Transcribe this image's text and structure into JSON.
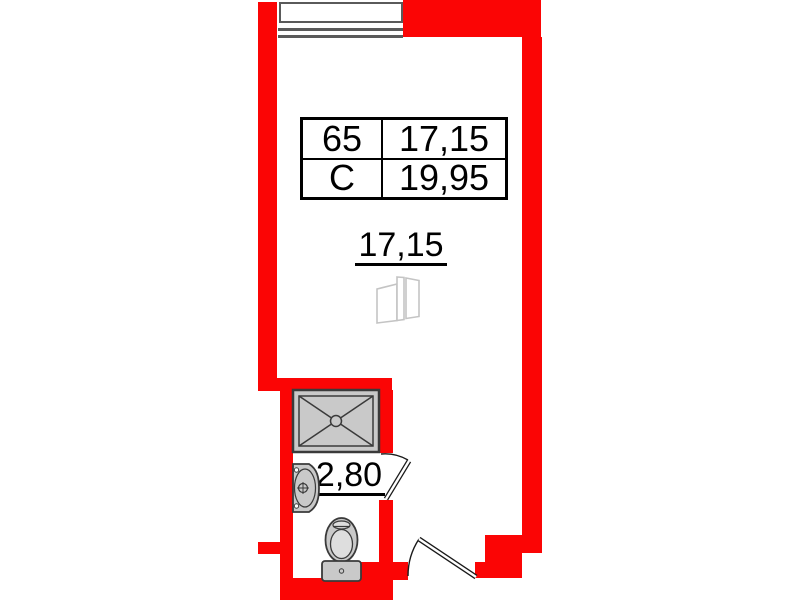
{
  "plan": {
    "unit_table": {
      "rows": [
        [
          "65",
          "17,15"
        ],
        [
          "С",
          "19,95"
        ]
      ]
    },
    "room_area_label": "17,15",
    "bathroom_area_label": "2,80",
    "colors": {
      "wall": "#fb0505",
      "fixture_fill": "#c9c9c9",
      "fixture_inner": "#dedede",
      "fixture_stroke": "#3a3a3a",
      "line": "#1a1a1a",
      "window_line": "#5a5a5a",
      "furniture_line": "#c4c4c4"
    },
    "icons": [
      "window-icon",
      "shower-tray-icon",
      "sink-icon",
      "toilet-icon",
      "wardrobe-icon",
      "door-swing-icon"
    ]
  }
}
